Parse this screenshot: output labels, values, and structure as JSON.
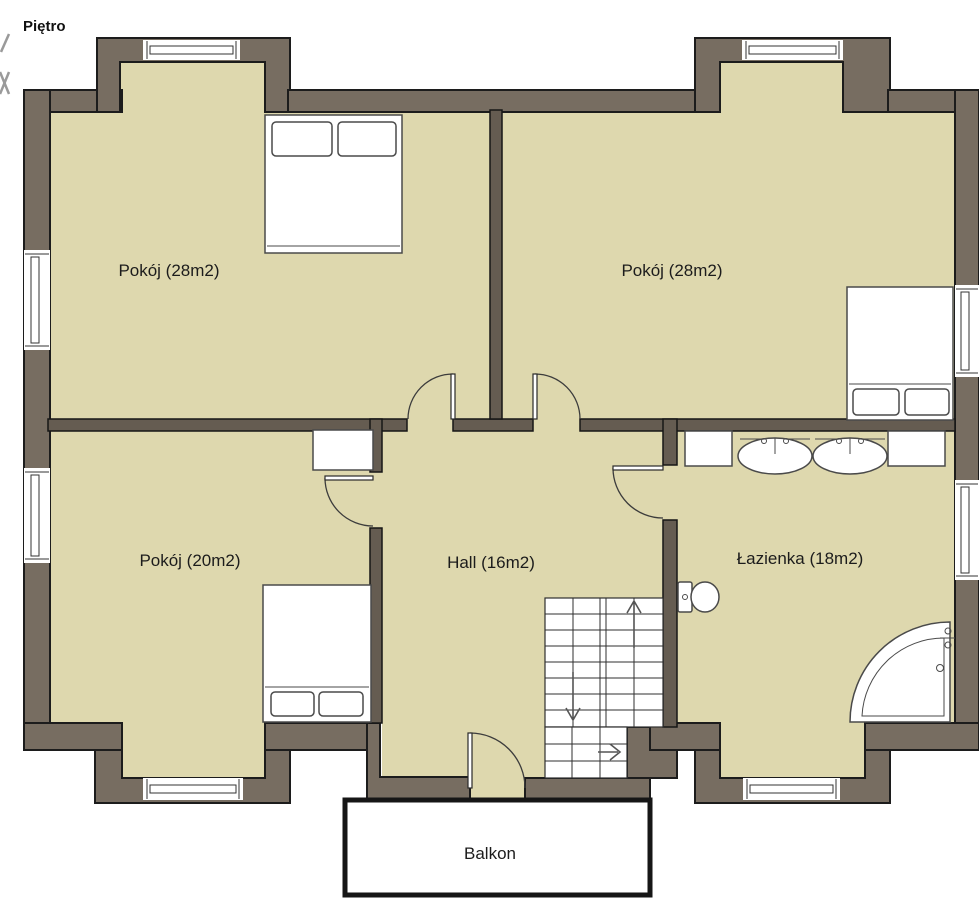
{
  "title": "Piętro",
  "rooms": {
    "room_tl": {
      "label": "Pokój (28m2)",
      "name": "Pokój",
      "area_m2": 28
    },
    "room_tr": {
      "label": "Pokój (28m2)",
      "name": "Pokój",
      "area_m2": 28
    },
    "room_ml": {
      "label": "Pokój (20m2)",
      "name": "Pokój",
      "area_m2": 20
    },
    "hall": {
      "label": "Hall (16m2)",
      "name": "Hall",
      "area_m2": 16
    },
    "bathroom": {
      "label": "Łazienka (18m2)",
      "name": "Łazienka",
      "area_m2": 18
    },
    "balcony": {
      "label": "Balkon",
      "name": "Balkon"
    }
  },
  "colors": {
    "floor": "#ded8ae",
    "exterior_wall": "#776d61",
    "interior_wall": "#655c51",
    "outline": "#1c1c1c",
    "fixture_stroke": "#4a4a4a",
    "background": "#ffffff"
  }
}
